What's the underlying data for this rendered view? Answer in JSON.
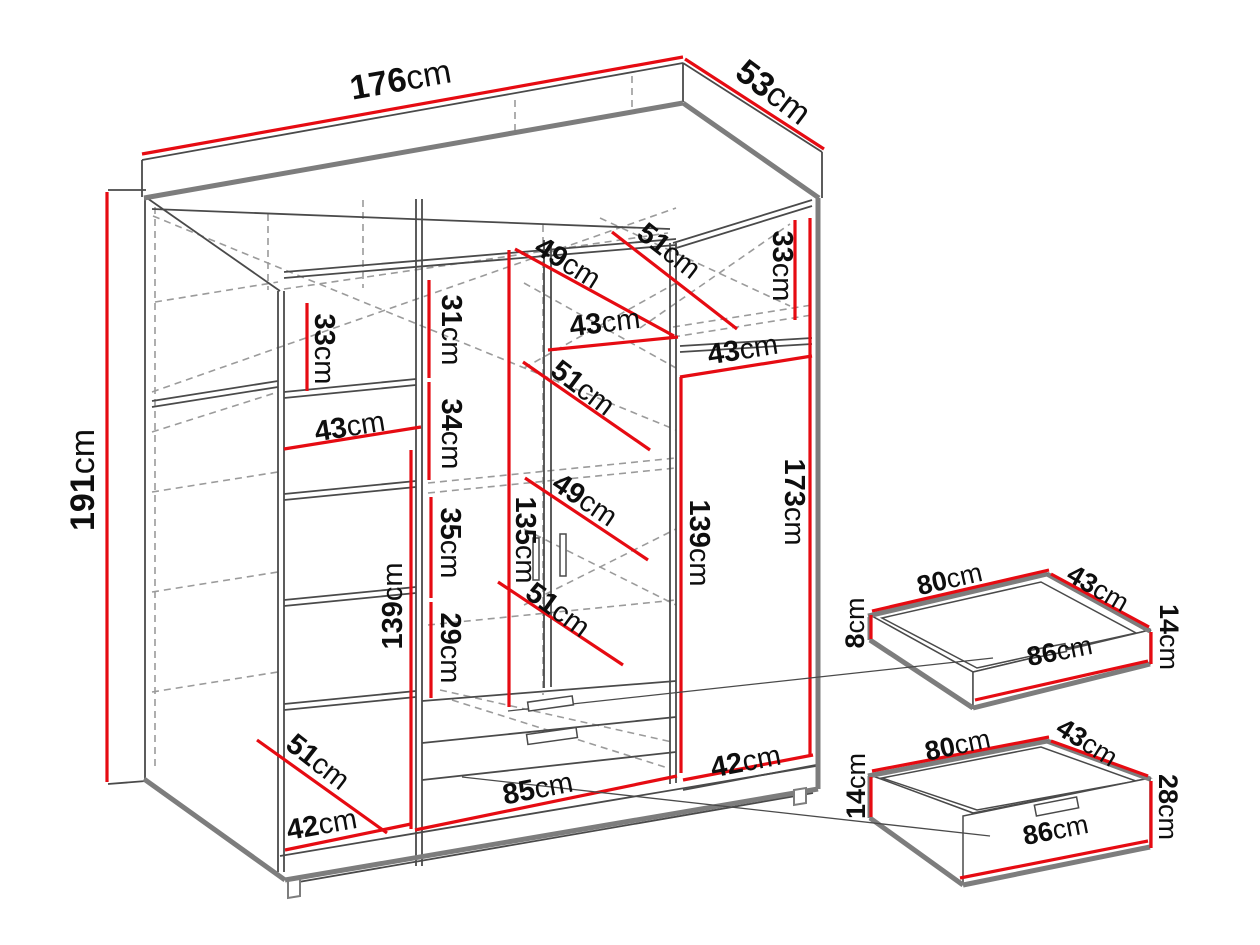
{
  "diagram": {
    "type": "furniture-dimension-diagram",
    "unit": "cm",
    "colors": {
      "background": "#ffffff",
      "dimension_red": "#e60b12",
      "structure_thin": "#4a4a4a",
      "structure_heavy": "#7d7d7d",
      "hidden_dashed": "#9b9b9b",
      "label_text": "#0e0e0e"
    },
    "wardrobe": {
      "name": "wardrobe-main-view",
      "overall_dimensions": {
        "width": "176cm",
        "depth": "53cm",
        "height": "191cm"
      },
      "labels": [
        {
          "value": "176",
          "x": 401,
          "y": 82,
          "rot": -10,
          "size": 34
        },
        {
          "value": "53",
          "x": 772,
          "y": 94,
          "rot": 37,
          "size": 34
        },
        {
          "value": "191",
          "x": 85,
          "y": 480,
          "rot": -90,
          "size": 34
        },
        {
          "value": "33",
          "x": 323,
          "y": 349,
          "rot": 90,
          "size": 29
        },
        {
          "value": "43",
          "x": 350,
          "y": 428,
          "rot": -9,
          "size": 29
        },
        {
          "value": "31",
          "x": 450,
          "y": 330,
          "rot": 90,
          "size": 29
        },
        {
          "value": "34",
          "x": 450,
          "y": 434,
          "rot": 90,
          "size": 29
        },
        {
          "value": "35",
          "x": 449,
          "y": 543,
          "rot": 90,
          "size": 29
        },
        {
          "value": "29",
          "x": 449,
          "y": 648,
          "rot": 90,
          "size": 29
        },
        {
          "value": "135",
          "x": 524,
          "y": 540,
          "rot": 90,
          "size": 29
        },
        {
          "value": "139",
          "x": 394,
          "y": 606,
          "rot": -90,
          "size": 29
        },
        {
          "value": "49",
          "x": 567,
          "y": 264,
          "rot": 32,
          "size": 29
        },
        {
          "value": "51",
          "x": 668,
          "y": 252,
          "rot": 38,
          "size": 29
        },
        {
          "value": "33",
          "x": 781,
          "y": 266,
          "rot": 90,
          "size": 29
        },
        {
          "value": "43",
          "x": 605,
          "y": 324,
          "rot": -7,
          "size": 29
        },
        {
          "value": "51",
          "x": 582,
          "y": 389,
          "rot": 37,
          "size": 29
        },
        {
          "value": "43",
          "x": 743,
          "y": 351,
          "rot": -9,
          "size": 29
        },
        {
          "value": "49",
          "x": 584,
          "y": 501,
          "rot": 34,
          "size": 29
        },
        {
          "value": "51",
          "x": 557,
          "y": 611,
          "rot": 36,
          "size": 29
        },
        {
          "value": "139",
          "x": 698,
          "y": 543,
          "rot": 90,
          "size": 29
        },
        {
          "value": "173",
          "x": 793,
          "y": 502,
          "rot": 90,
          "size": 29
        },
        {
          "value": "51",
          "x": 317,
          "y": 763,
          "rot": 38,
          "size": 29
        },
        {
          "value": "42",
          "x": 322,
          "y": 826,
          "rot": -10,
          "size": 29
        },
        {
          "value": "85",
          "x": 538,
          "y": 790,
          "rot": -11,
          "size": 29
        },
        {
          "value": "42",
          "x": 746,
          "y": 763,
          "rot": -11,
          "size": 29
        }
      ],
      "red_lines": [
        [
          142,
          154,
          683,
          57
        ],
        [
          685,
          59,
          824,
          149
        ],
        [
          107,
          192,
          107,
          782
        ],
        [
          307,
          303,
          307,
          391
        ],
        [
          284,
          449,
          421,
          427
        ],
        [
          429,
          280,
          429,
          378
        ],
        [
          429,
          382,
          429,
          480
        ],
        [
          431,
          497,
          431,
          598
        ],
        [
          431,
          602,
          431,
          698
        ],
        [
          509,
          250,
          509,
          707
        ],
        [
          411,
          450,
          411,
          829
        ],
        [
          515,
          249,
          674,
          336
        ],
        [
          612,
          232,
          737,
          329
        ],
        [
          795,
          220,
          795,
          320
        ],
        [
          548,
          350,
          678,
          337
        ],
        [
          523,
          362,
          650,
          450
        ],
        [
          680,
          377,
          812,
          356
        ],
        [
          525,
          478,
          648,
          560
        ],
        [
          498,
          582,
          623,
          665
        ],
        [
          681,
          377,
          681,
          773
        ],
        [
          810,
          218,
          810,
          755
        ],
        [
          257,
          740,
          387,
          833
        ],
        [
          285,
          850,
          411,
          824
        ],
        [
          415,
          830,
          677,
          776
        ],
        [
          683,
          780,
          813,
          755
        ]
      ],
      "thin_lines": [
        [
          142,
          160,
          683,
          63
        ],
        [
          683,
          63,
          822,
          152
        ],
        [
          142,
          160,
          142,
          197
        ],
        [
          683,
          63,
          683,
          102
        ],
        [
          822,
          152,
          822,
          198
        ],
        [
          145,
          197,
          145,
          779
        ],
        [
          147,
          198,
          280,
          291
        ],
        [
          152,
          209,
          670,
          229
        ],
        [
          673,
          243,
          812,
          200
        ],
        [
          673,
          249,
          812,
          206
        ],
        [
          278,
          291,
          278,
          872
        ],
        [
          284,
          291,
          284,
          872
        ],
        [
          416,
          199,
          416,
          866
        ],
        [
          422,
          199,
          422,
          866
        ],
        [
          544,
          240,
          544,
          688
        ],
        [
          551,
          240,
          551,
          687
        ],
        [
          284,
          272,
          676,
          239
        ],
        [
          284,
          278,
          676,
          245
        ],
        [
          284,
          392,
          416,
          379
        ],
        [
          284,
          398,
          416,
          385
        ],
        [
          284,
          494,
          416,
          481
        ],
        [
          284,
          500,
          416,
          487
        ],
        [
          284,
          600,
          416,
          587
        ],
        [
          284,
          606,
          416,
          593
        ],
        [
          284,
          704,
          416,
          691
        ],
        [
          284,
          710,
          416,
          697
        ],
        [
          152,
          401,
          278,
          381
        ],
        [
          152,
          407,
          278,
          387
        ],
        [
          422,
          701,
          676,
          681
        ],
        [
          422,
          743,
          676,
          717
        ],
        [
          422,
          780,
          676,
          752
        ],
        [
          670,
          243,
          670,
          784
        ],
        [
          676,
          243,
          676,
          783
        ],
        [
          680,
          346,
          812,
          338
        ],
        [
          680,
          352,
          812,
          344
        ],
        [
          683,
          790,
          816,
          765
        ],
        [
          280,
          856,
          816,
          766
        ],
        [
          287,
          884,
          813,
          793
        ],
        [
          108,
          190,
          146,
          190
        ],
        [
          108,
          784,
          146,
          781
        ]
      ],
      "heavy_lines": [
        [
          144,
          198,
          683,
          103
        ],
        [
          683,
          103,
          819,
          198
        ],
        [
          818,
          198,
          818,
          789
        ],
        [
          144,
          779,
          285,
          880
        ],
        [
          285,
          880,
          818,
          789
        ]
      ],
      "dashed_lines": [
        [
          155,
          207,
          155,
          770
        ],
        [
          153,
          216,
          676,
          430
        ],
        [
          152,
          392,
          676,
          208
        ],
        [
          152,
          432,
          278,
          392
        ],
        [
          152,
          492,
          278,
          472
        ],
        [
          152,
          592,
          278,
          572
        ],
        [
          152,
          692,
          278,
          672
        ],
        [
          155,
          302,
          278,
          282
        ],
        [
          284,
          289,
          668,
          233
        ],
        [
          524,
          283,
          676,
          368
        ],
        [
          524,
          368,
          676,
          283
        ],
        [
          428,
          483,
          676,
          458
        ],
        [
          428,
          493,
          676,
          468
        ],
        [
          524,
          529,
          676,
          605
        ],
        [
          524,
          605,
          676,
          529
        ],
        [
          428,
          625,
          676,
          600
        ],
        [
          440,
          690,
          672,
          742
        ],
        [
          452,
          700,
          668,
          768
        ],
        [
          673,
          327,
          812,
          305
        ],
        [
          673,
          337,
          812,
          315
        ],
        [
          600,
          218,
          790,
          306
        ],
        [
          640,
          328,
          790,
          224
        ],
        [
          543,
          225,
          543,
          695
        ],
        [
          363,
          200,
          363,
          288
        ],
        [
          268,
          214,
          268,
          290
        ],
        [
          515,
          100,
          515,
          133
        ],
        [
          632,
          76,
          632,
          112
        ]
      ],
      "feet": [
        [
          [
            288,
            881
          ],
          [
            300,
            879
          ],
          [
            300,
            896
          ],
          [
            288,
            898
          ]
        ],
        [
          [
            794,
            790
          ],
          [
            806,
            788
          ],
          [
            806,
            803
          ],
          [
            794,
            805
          ]
        ]
      ],
      "handles": [
        {
          "x": 533,
          "y": 538,
          "w": 6,
          "h": 42,
          "rot": 0
        },
        {
          "x": 560,
          "y": 534,
          "w": 6,
          "h": 42,
          "rot": 0
        },
        {
          "x": 528,
          "y": 699,
          "w": 45,
          "h": 9,
          "rot": -8
        },
        {
          "x": 527,
          "y": 731,
          "w": 50,
          "h": 10,
          "rot": -8
        }
      ],
      "faces": []
    },
    "drawer_detail_top": {
      "name": "drawer-detail-shallow",
      "dimensions": {
        "width": "80cm",
        "depth": "43cm",
        "side_height": "8cm",
        "front_height": "14cm",
        "front_width": "86cm"
      },
      "labels": [
        {
          "value": "80",
          "x": 950,
          "y": 581,
          "rot": -13,
          "size": 27
        },
        {
          "value": "43",
          "x": 1097,
          "y": 590,
          "rot": 30,
          "size": 27
        },
        {
          "value": "8",
          "x": 857,
          "y": 623,
          "rot": -90,
          "size": 27
        },
        {
          "value": "14",
          "x": 1167,
          "y": 637,
          "rot": 90,
          "size": 27
        },
        {
          "value": "86",
          "x": 1060,
          "y": 653,
          "rot": -11,
          "size": 27
        }
      ],
      "faces": [
        [
          [
            870,
            615
          ],
          [
            1047,
            573
          ],
          [
            1150,
            630
          ],
          [
            973,
            672
          ]
        ],
        [
          [
            882,
            618
          ],
          [
            1041,
            582
          ],
          [
            1136,
            633
          ],
          [
            977,
            668
          ]
        ],
        [
          [
            870,
            615
          ],
          [
            870,
            640
          ],
          [
            973,
            708
          ],
          [
            973,
            672
          ]
        ],
        [
          [
            973,
            672
          ],
          [
            1150,
            630
          ],
          [
            1150,
            664
          ],
          [
            973,
            708
          ]
        ]
      ],
      "heavy_lines": [
        [
          868,
          616,
          1047,
          574
        ],
        [
          1047,
          574,
          1150,
          631
        ],
        [
          870,
          617,
          870,
          640
        ],
        [
          870,
          640,
          973,
          708
        ],
        [
          973,
          708,
          1150,
          664
        ]
      ],
      "thin_lines": [],
      "dashed_lines": [],
      "red_lines": [
        [
          872,
          611,
          1049,
          570
        ],
        [
          1051,
          574,
          1149,
          627
        ],
        [
          871,
          615,
          871,
          639
        ],
        [
          1151,
          632,
          1151,
          664
        ],
        [
          975,
          700,
          1148,
          661
        ]
      ],
      "handles": [
        {
          "x": 1030,
          "y": 647,
          "w": 36,
          "h": 8,
          "rot": -11
        }
      ],
      "feet": []
    },
    "drawer_detail_bottom": {
      "name": "drawer-detail-deep",
      "dimensions": {
        "width": "80cm",
        "depth": "43cm",
        "side_height": "14cm",
        "front_height": "28cm",
        "front_width": "86cm"
      },
      "labels": [
        {
          "value": "80",
          "x": 958,
          "y": 747,
          "rot": -12,
          "size": 27
        },
        {
          "value": "43",
          "x": 1086,
          "y": 744,
          "rot": 32,
          "size": 27
        },
        {
          "value": "14",
          "x": 858,
          "y": 786,
          "rot": -90,
          "size": 27
        },
        {
          "value": "28",
          "x": 1166,
          "y": 807,
          "rot": 90,
          "size": 27
        },
        {
          "value": "86",
          "x": 1056,
          "y": 832,
          "rot": -11,
          "size": 27
        }
      ],
      "faces": [
        [
          [
            870,
            775
          ],
          [
            1047,
            740
          ],
          [
            1150,
            778
          ],
          [
            973,
            813
          ]
        ],
        [
          [
            882,
            778
          ],
          [
            1041,
            747
          ],
          [
            1136,
            781
          ],
          [
            977,
            810
          ]
        ],
        [
          [
            870,
            775
          ],
          [
            870,
            818
          ],
          [
            963,
            884
          ],
          [
            973,
            813
          ]
        ],
        [
          [
            963,
            816
          ],
          [
            1150,
            778
          ],
          [
            1150,
            846
          ],
          [
            963,
            884
          ]
        ]
      ],
      "heavy_lines": [
        [
          868,
          776,
          1047,
          741
        ],
        [
          1047,
          741,
          1150,
          779
        ],
        [
          870,
          776,
          870,
          818
        ],
        [
          870,
          818,
          963,
          885
        ],
        [
          963,
          885,
          1150,
          847
        ]
      ],
      "thin_lines": [],
      "dashed_lines": [],
      "red_lines": [
        [
          872,
          771,
          1049,
          737
        ],
        [
          1051,
          741,
          1148,
          776
        ],
        [
          871,
          777,
          871,
          817
        ],
        [
          1151,
          781,
          1151,
          848
        ],
        [
          960,
          878,
          1148,
          841
        ]
      ],
      "handles": [
        {
          "x": 1035,
          "y": 801,
          "w": 43,
          "h": 11,
          "rot": -11
        }
      ],
      "feet": []
    },
    "pointer_lines": [
      [
        508,
        711,
        993,
        658
      ],
      [
        462,
        777,
        990,
        836
      ]
    ]
  }
}
